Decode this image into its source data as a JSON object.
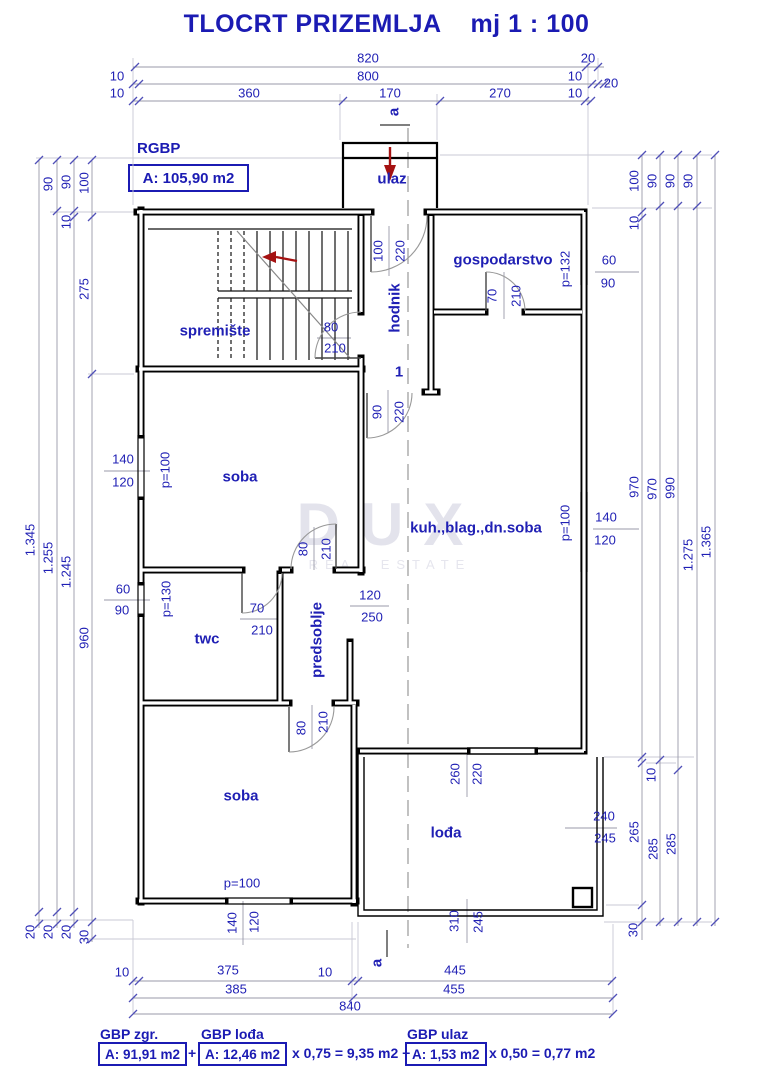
{
  "title": {
    "main": "TLOCRT PRIZEMLJA",
    "scale": "mj 1 : 100"
  },
  "area_header": {
    "label": "RGBP",
    "value": "A: 105,90 m2"
  },
  "watermark": {
    "line1": "DUX",
    "line2": "REAL ESTATE"
  },
  "legend": {
    "groups": [
      {
        "title": "GBP zgr.",
        "area": "A: 91,91 m2",
        "suffix": "+"
      },
      {
        "title": "GBP lođa",
        "area": "A: 12,46 m2",
        "suffix": "x 0,75 = 9,35 m2 +"
      },
      {
        "title": "GBP ulaz",
        "area": "A: 1,53 m2",
        "suffix": "x 0,50 = 0,77 m2"
      }
    ]
  },
  "colors": {
    "accent_blue": "#1b1bb3",
    "wall_black": "#000000",
    "arrow_red": "#a51212",
    "dim_gray": "#9a9aa8",
    "watermark_gray": "#e3e3ec"
  },
  "plan_labels": [
    {
      "t": "820",
      "x": 368,
      "y": 58
    },
    {
      "t": "20",
      "x": 588,
      "y": 58
    },
    {
      "t": "10",
      "x": 117,
      "y": 76
    },
    {
      "t": "800",
      "x": 368,
      "y": 76
    },
    {
      "t": "10",
      "x": 575,
      "y": 76
    },
    {
      "t": "20",
      "x": 611,
      "y": 83
    },
    {
      "t": "10",
      "x": 117,
      "y": 93
    },
    {
      "t": "360",
      "x": 249,
      "y": 93
    },
    {
      "t": "170",
      "x": 390,
      "y": 93
    },
    {
      "t": "270",
      "x": 500,
      "y": 93
    },
    {
      "t": "10",
      "x": 575,
      "y": 93
    },
    {
      "t": "1.345",
      "x": 30,
      "y": 540,
      "r": 1
    },
    {
      "t": "20",
      "x": 30,
      "y": 932,
      "r": 1
    },
    {
      "t": "90",
      "x": 48,
      "y": 184,
      "r": 1
    },
    {
      "t": "1.255",
      "x": 48,
      "y": 558,
      "r": 1
    },
    {
      "t": "20",
      "x": 48,
      "y": 932,
      "r": 1
    },
    {
      "t": "90",
      "x": 66,
      "y": 182,
      "r": 1
    },
    {
      "t": "10",
      "x": 66,
      "y": 222,
      "r": 1
    },
    {
      "t": "1.245",
      "x": 66,
      "y": 572,
      "r": 1
    },
    {
      "t": "20",
      "x": 66,
      "y": 932,
      "r": 1
    },
    {
      "t": "100",
      "x": 84,
      "y": 183,
      "r": 1
    },
    {
      "t": "275",
      "x": 84,
      "y": 289,
      "r": 1
    },
    {
      "t": "960",
      "x": 84,
      "y": 638,
      "r": 1
    },
    {
      "t": "30",
      "x": 84,
      "y": 937,
      "r": 1
    },
    {
      "t": "100",
      "x": 634,
      "y": 181,
      "r": 1
    },
    {
      "t": "10",
      "x": 634,
      "y": 223,
      "r": 1
    },
    {
      "t": "970",
      "x": 634,
      "y": 487,
      "r": 1
    },
    {
      "t": "10",
      "x": 651,
      "y": 775,
      "r": 1
    },
    {
      "t": "265",
      "x": 634,
      "y": 832,
      "r": 1
    },
    {
      "t": "30",
      "x": 633,
      "y": 930,
      "r": 1
    },
    {
      "t": "90",
      "x": 652,
      "y": 181,
      "r": 1
    },
    {
      "t": "970",
      "x": 652,
      "y": 489,
      "r": 1
    },
    {
      "t": "285",
      "x": 653,
      "y": 849,
      "r": 1
    },
    {
      "t": "90",
      "x": 670,
      "y": 181,
      "r": 1
    },
    {
      "t": "990",
      "x": 670,
      "y": 488,
      "r": 1
    },
    {
      "t": "285",
      "x": 671,
      "y": 844,
      "r": 1
    },
    {
      "t": "90",
      "x": 688,
      "y": 181,
      "r": 1
    },
    {
      "t": "1.275",
      "x": 688,
      "y": 555,
      "r": 1
    },
    {
      "t": "1.365",
      "x": 706,
      "y": 542,
      "r": 1
    },
    {
      "t": "10",
      "x": 122,
      "y": 972
    },
    {
      "t": "375",
      "x": 228,
      "y": 970
    },
    {
      "t": "10",
      "x": 325,
      "y": 972
    },
    {
      "t": "445",
      "x": 455,
      "y": 970
    },
    {
      "t": "385",
      "x": 236,
      "y": 989
    },
    {
      "t": "455",
      "x": 454,
      "y": 989
    },
    {
      "t": "840",
      "x": 350,
      "y": 1006
    },
    {
      "t": "a",
      "x": 394,
      "y": 112,
      "r": 1,
      "c": "b",
      "n": "section-marker-a-top"
    },
    {
      "t": "a",
      "x": 377,
      "y": 963,
      "r": 1,
      "c": "b",
      "n": "section-marker-a-bottom"
    },
    {
      "t": "ulaz",
      "x": 392,
      "y": 179,
      "c": "b",
      "n": "room-label-ulaz"
    },
    {
      "t": "hodnik",
      "x": 395,
      "y": 308,
      "r": 1,
      "c": "b",
      "n": "room-label-hodnik"
    },
    {
      "t": "1",
      "x": 399,
      "y": 372,
      "c": "b",
      "n": "stair-number-label"
    },
    {
      "t": "gospodarstvo",
      "x": 503,
      "y": 260,
      "c": "b",
      "n": "room-label-gospodarstvo"
    },
    {
      "t": "spremište",
      "x": 215,
      "y": 331,
      "c": "b",
      "n": "room-label-spremiste"
    },
    {
      "t": "soba",
      "x": 240,
      "y": 477,
      "c": "b",
      "n": "room-label-soba-1"
    },
    {
      "t": "kuh.,blag.,dn.soba",
      "x": 476,
      "y": 528,
      "c": "b",
      "n": "room-label-kuhinja"
    },
    {
      "t": "twc",
      "x": 207,
      "y": 639,
      "c": "b",
      "n": "room-label-twc"
    },
    {
      "t": "predsoblje",
      "x": 317,
      "y": 640,
      "r": 1,
      "c": "b",
      "n": "room-label-predsoblje"
    },
    {
      "t": "soba",
      "x": 241,
      "y": 796,
      "c": "b",
      "n": "room-label-soba-2"
    },
    {
      "t": "lođa",
      "x": 446,
      "y": 833,
      "c": "b",
      "n": "room-label-loda"
    },
    {
      "t": "100",
      "x": 378,
      "y": 251,
      "r": 1
    },
    {
      "t": "220",
      "x": 400,
      "y": 251,
      "r": 1
    },
    {
      "t": "80",
      "x": 331,
      "y": 327
    },
    {
      "t": "210",
      "x": 335,
      "y": 348
    },
    {
      "t": "90",
      "x": 377,
      "y": 412,
      "r": 1
    },
    {
      "t": "220",
      "x": 399,
      "y": 412,
      "r": 1
    },
    {
      "t": "70",
      "x": 492,
      "y": 296,
      "r": 1
    },
    {
      "t": "210",
      "x": 516,
      "y": 296,
      "r": 1
    },
    {
      "t": "80",
      "x": 303,
      "y": 549,
      "r": 1
    },
    {
      "t": "210",
      "x": 326,
      "y": 549,
      "r": 1
    },
    {
      "t": "70",
      "x": 257,
      "y": 608
    },
    {
      "t": "210",
      "x": 262,
      "y": 630
    },
    {
      "t": "120",
      "x": 370,
      "y": 595
    },
    {
      "t": "250",
      "x": 372,
      "y": 617
    },
    {
      "t": "80",
      "x": 301,
      "y": 728,
      "r": 1
    },
    {
      "t": "210",
      "x": 323,
      "y": 722,
      "r": 1
    },
    {
      "t": "260",
      "x": 455,
      "y": 774,
      "r": 1
    },
    {
      "t": "220",
      "x": 477,
      "y": 774,
      "r": 1
    },
    {
      "t": "240",
      "x": 604,
      "y": 816
    },
    {
      "t": "245",
      "x": 605,
      "y": 838
    },
    {
      "t": "310",
      "x": 454,
      "y": 921,
      "r": 1
    },
    {
      "t": "245",
      "x": 478,
      "y": 922,
      "r": 1
    },
    {
      "t": "140",
      "x": 123,
      "y": 459
    },
    {
      "t": "120",
      "x": 123,
      "y": 482
    },
    {
      "t": "p=100",
      "x": 165,
      "y": 470,
      "r": 1
    },
    {
      "t": "60",
      "x": 123,
      "y": 589
    },
    {
      "t": "90",
      "x": 122,
      "y": 610
    },
    {
      "t": "p=130",
      "x": 166,
      "y": 599,
      "r": 1
    },
    {
      "t": "p=100",
      "x": 242,
      "y": 883
    },
    {
      "t": "140",
      "x": 232,
      "y": 923,
      "r": 1
    },
    {
      "t": "120",
      "x": 254,
      "y": 922,
      "r": 1
    },
    {
      "t": "p=100",
      "x": 565,
      "y": 523,
      "r": 1
    },
    {
      "t": "140",
      "x": 606,
      "y": 517
    },
    {
      "t": "120",
      "x": 605,
      "y": 540
    },
    {
      "t": "p=132",
      "x": 565,
      "y": 269,
      "r": 1
    },
    {
      "t": "60",
      "x": 609,
      "y": 260
    },
    {
      "t": "90",
      "x": 608,
      "y": 283
    }
  ]
}
